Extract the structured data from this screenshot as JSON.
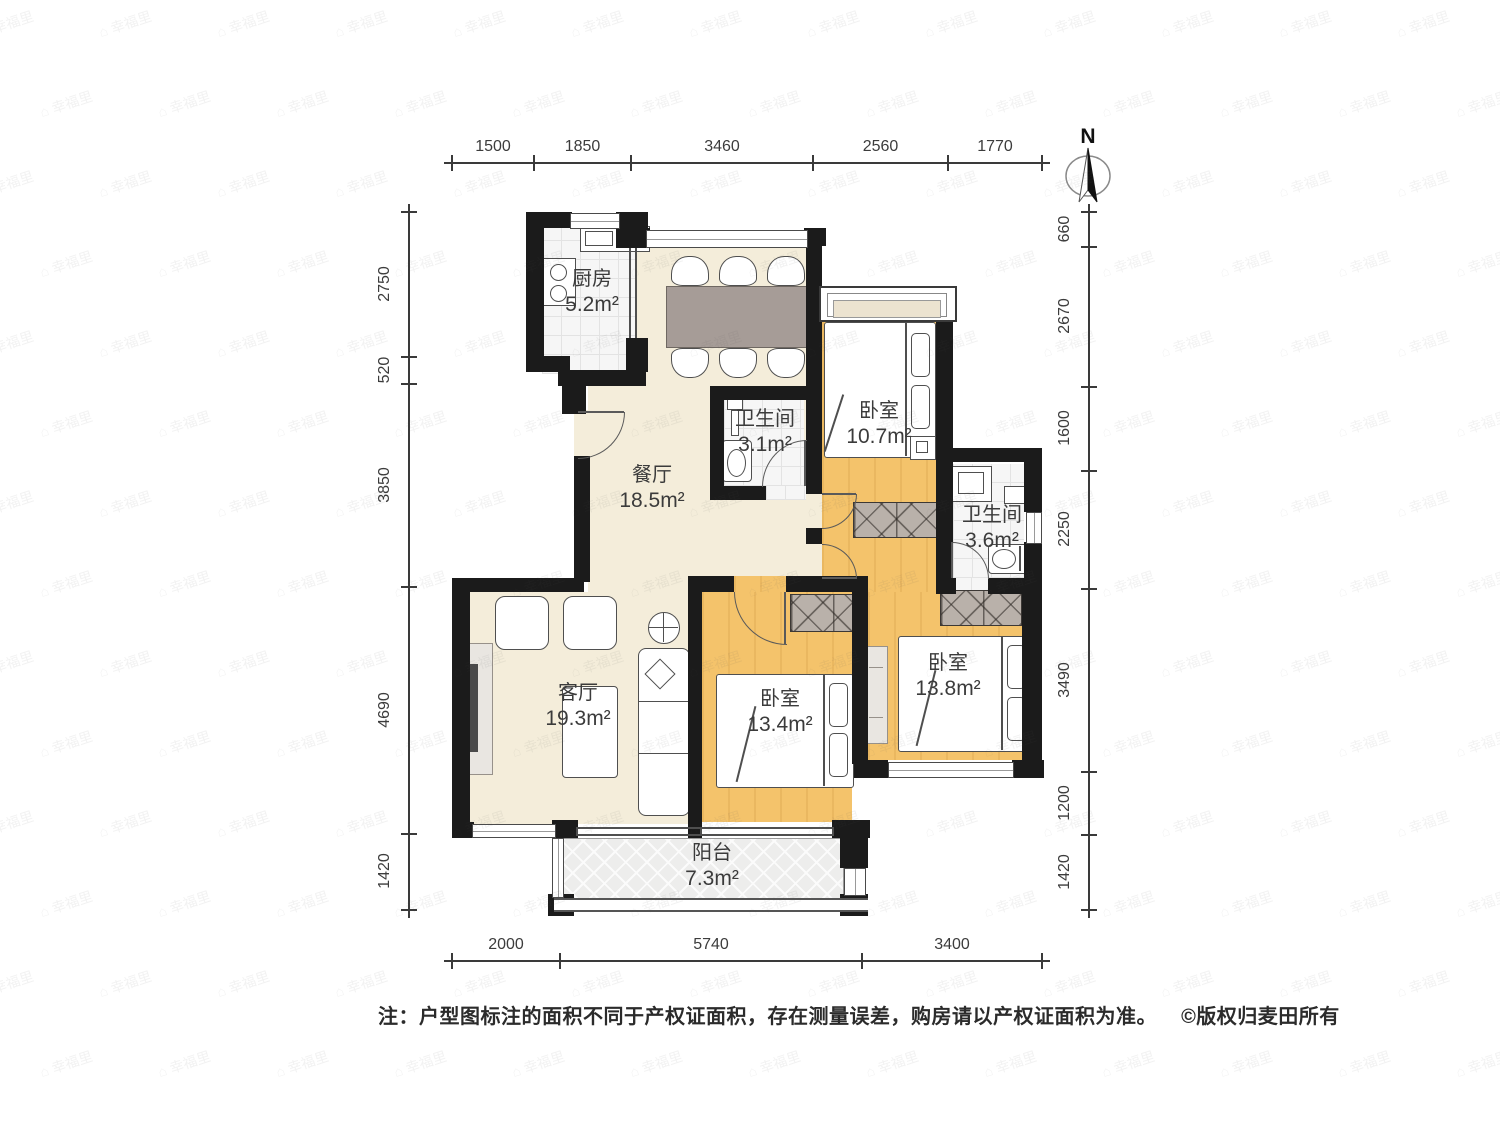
{
  "watermark": {
    "text": "幸福里"
  },
  "compass": {
    "north": "N"
  },
  "rooms": [
    {
      "name": "厨房",
      "area": "5.2m²"
    },
    {
      "name": "餐厅",
      "area": "18.5m²"
    },
    {
      "name": "卫生间",
      "area": "3.1m²"
    },
    {
      "name": "卧室",
      "area": "10.7m²"
    },
    {
      "name": "卫生间",
      "area": "3.6m²"
    },
    {
      "name": "客厅",
      "area": "19.3m²"
    },
    {
      "name": "卧室",
      "area": "13.4m²"
    },
    {
      "name": "卧室",
      "area": "13.8m²"
    },
    {
      "name": "阳台",
      "area": "7.3m²"
    }
  ],
  "dimensions": {
    "top": [
      "1500",
      "1850",
      "3460",
      "2560",
      "1770"
    ],
    "left": [
      "2750",
      "520",
      "3850",
      "4690",
      "1420"
    ],
    "right": [
      "660",
      "2670",
      "1600",
      "2250",
      "3490",
      "1200",
      "1420"
    ],
    "bottom": [
      "2000",
      "5740",
      "3400"
    ]
  },
  "note": {
    "text": "注：户型图标注的面积不同于产权证面积，存在测量误差，购房请以产权证面积为准。",
    "copyright": "©版权归麦田所有"
  }
}
